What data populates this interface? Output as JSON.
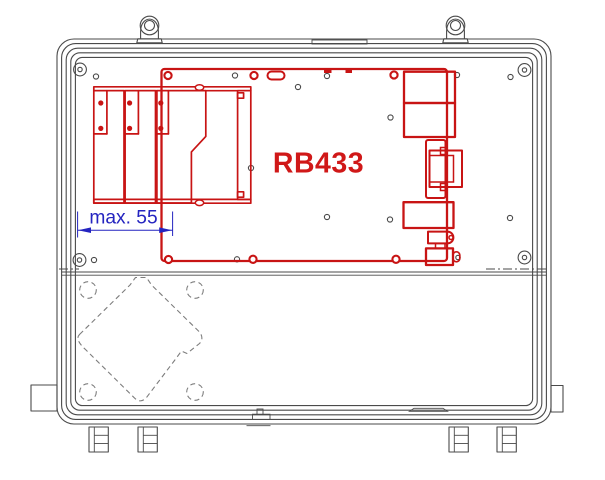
{
  "drawing": {
    "board_label": "RB433",
    "dimension_label": "max. 55",
    "colors": {
      "board": "#c81414",
      "board_text": "#d01818",
      "dimension": "#2424c0",
      "enclosure": "#4a4a4a",
      "hidden_line": "#7d7d7d",
      "background": "#ffffff"
    }
  }
}
